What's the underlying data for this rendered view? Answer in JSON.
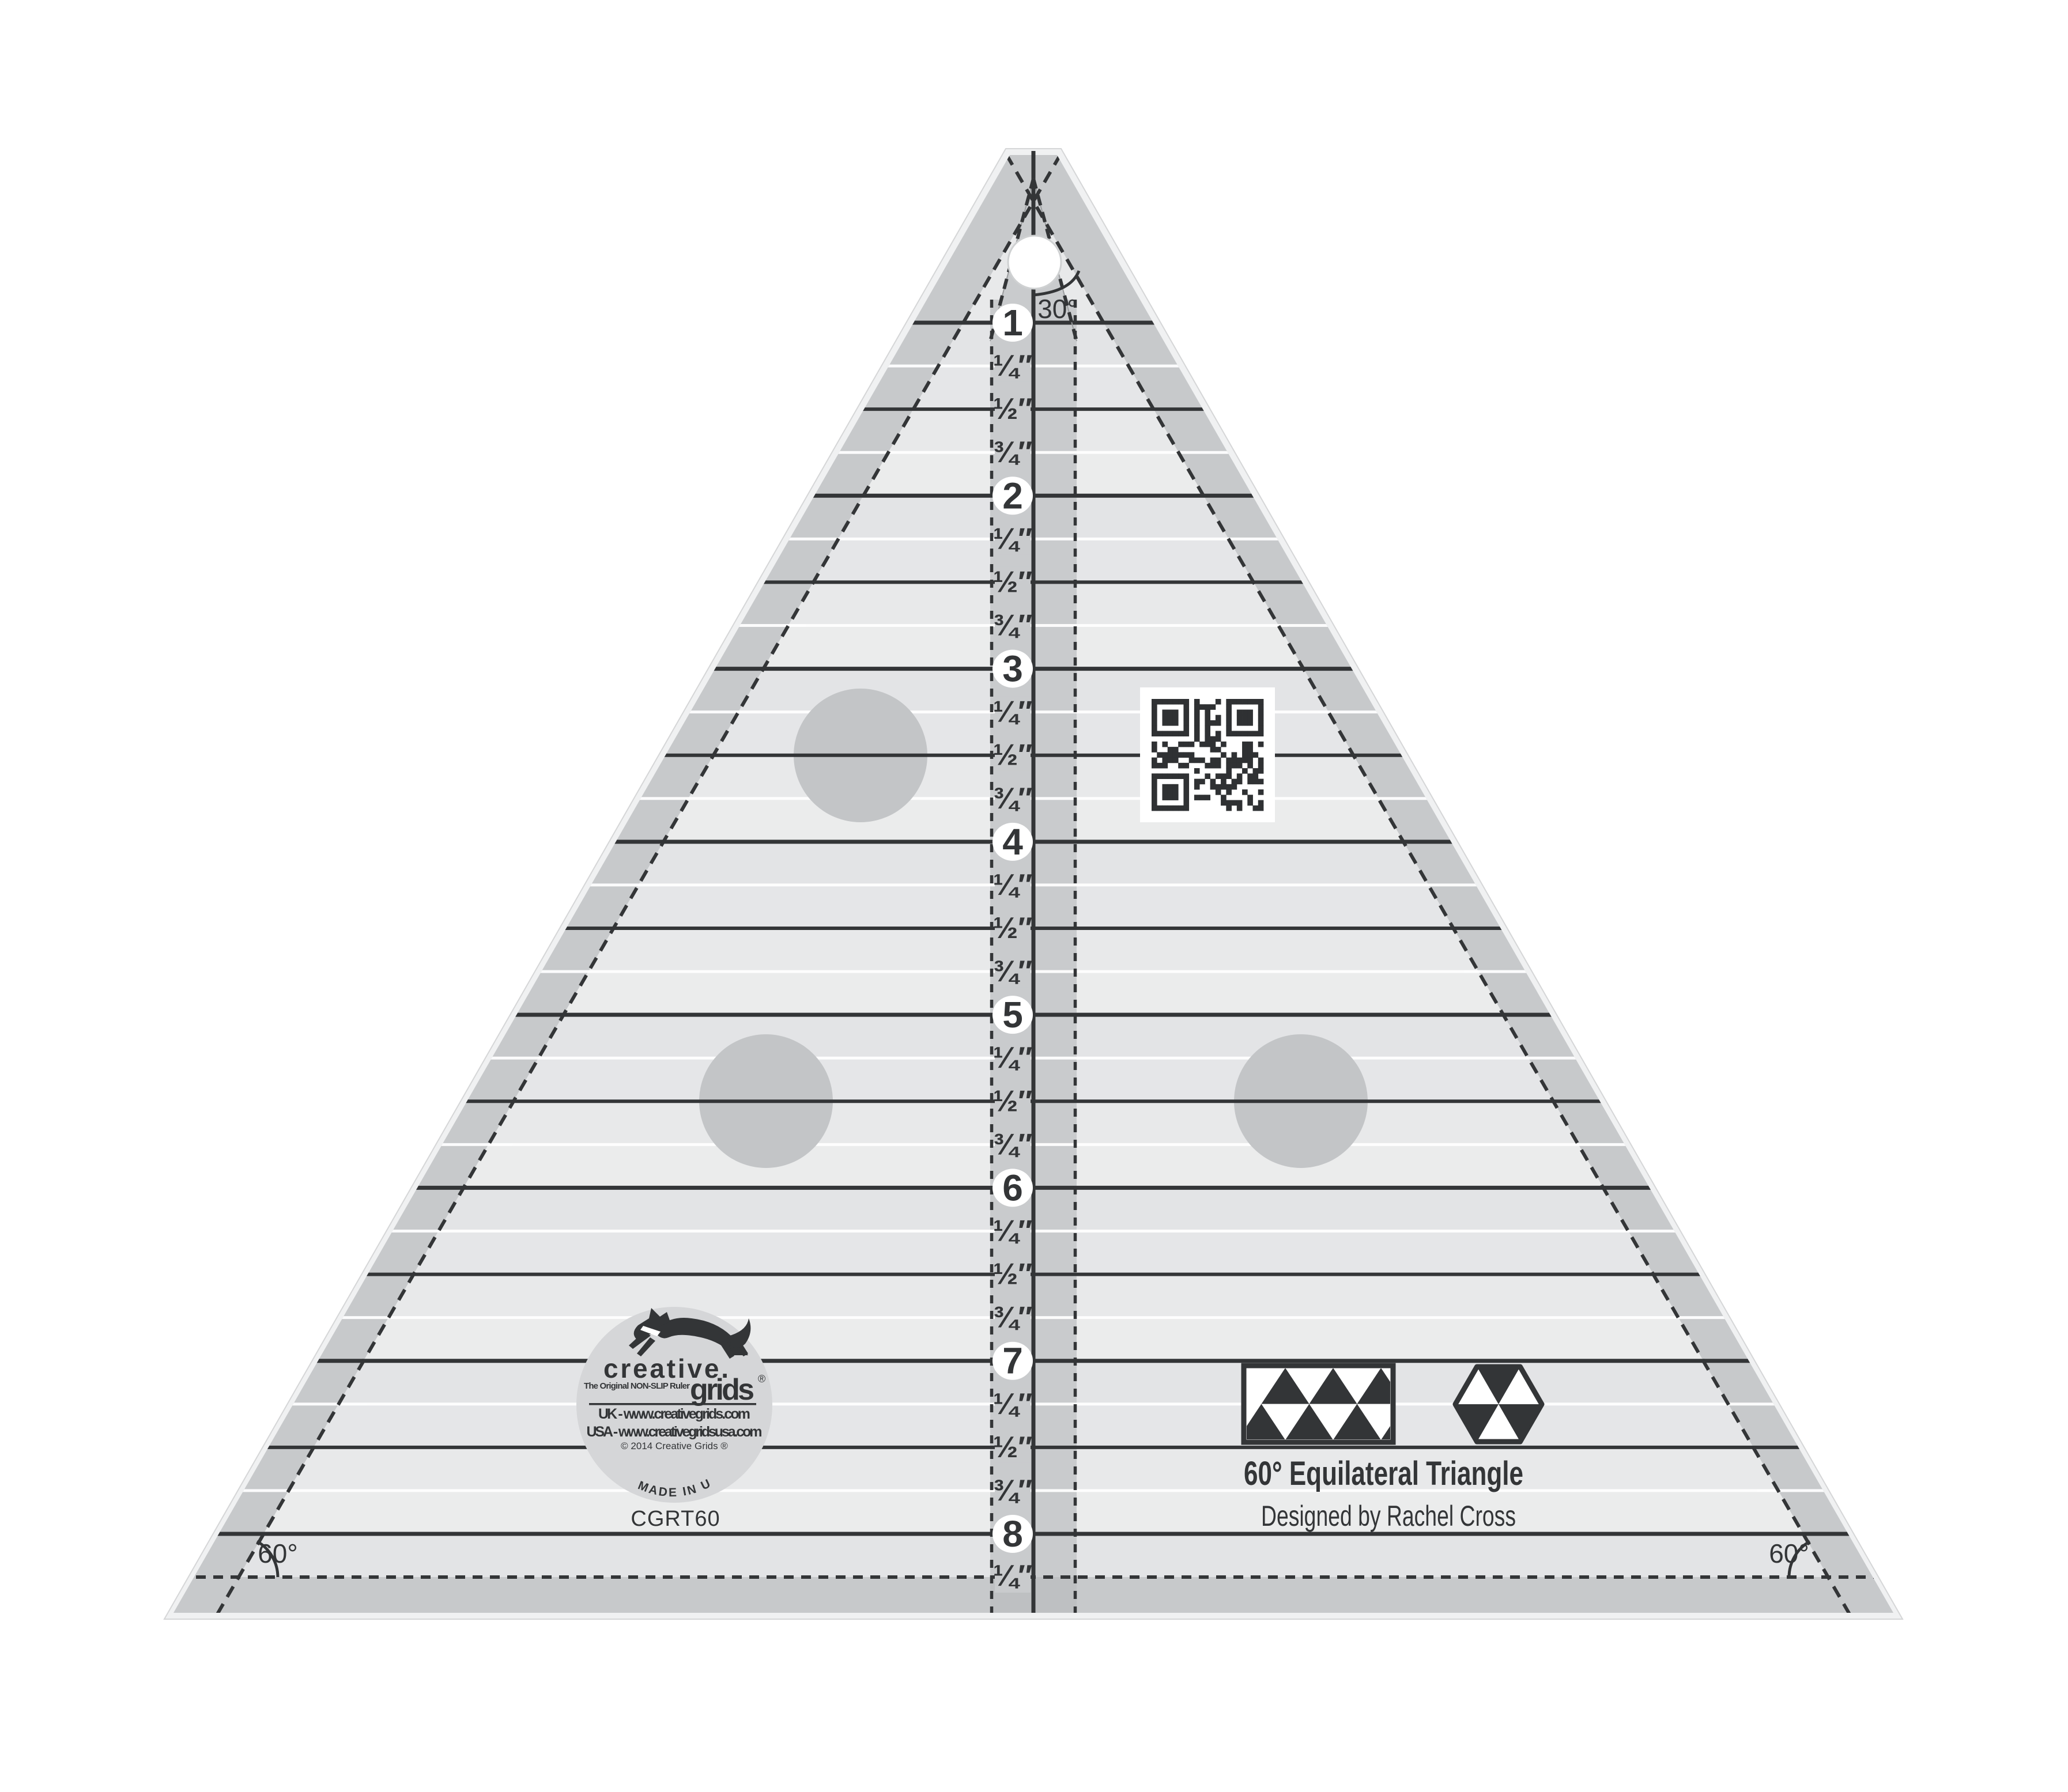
{
  "product": {
    "model": "CGRT60",
    "title": "60° Equilateral Triangle",
    "designer": "Designed by Rachel Cross",
    "apex_angle": "30°",
    "corner_angle": "60°"
  },
  "logo": {
    "brand_top": "creative.",
    "brand_bottom": "grids",
    "registered_mark": "®",
    "tagline": "The Original NON-SLIP Ruler",
    "url_uk": "UK - www.creativegrids.com",
    "url_usa": "USA - www.creativegridsusa.com",
    "copyright": "© 2014 Creative Grids ®",
    "made_in": "MADE IN USA"
  },
  "ruler": {
    "inch_numbers": [
      "1",
      "2",
      "3",
      "4",
      "5",
      "6",
      "7",
      "8"
    ],
    "fraction_labels": [
      "¼",
      "½",
      "¾"
    ],
    "inch_mark": "″",
    "seam_fraction": "¼"
  },
  "colors": {
    "dark": "#333537",
    "body": "#e8e9ea",
    "margin": "#c7c9cb",
    "column": "#c9cbcd",
    "dot": "#c3c5c7",
    "bevel": "#f0f1f2",
    "bevel_edge": "#d5d6d7",
    "logo_bg": "#d5d6d8",
    "band_a": "#e3e4e6",
    "band_b": "#e5e6e8",
    "band_c": "#e8e9ea",
    "band_d": "#ebecec",
    "white": "#ffffff"
  }
}
